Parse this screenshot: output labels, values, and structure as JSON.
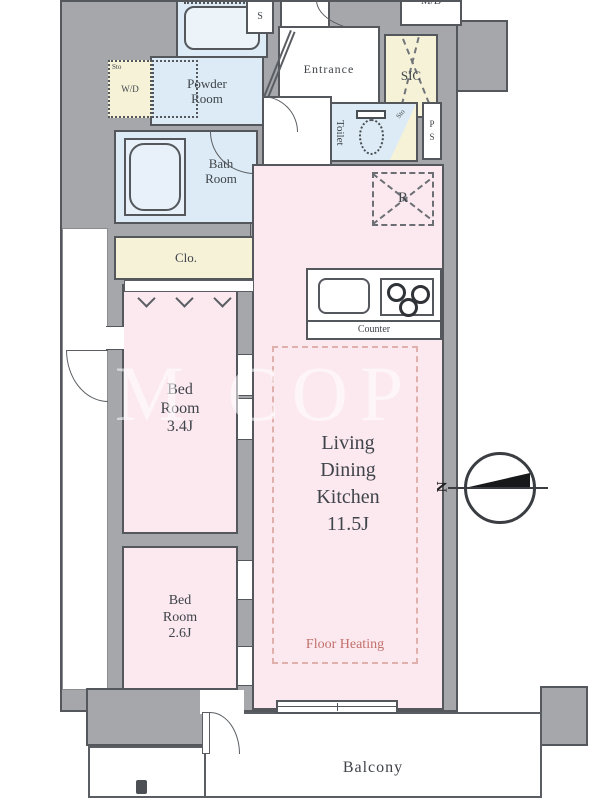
{
  "plan_type": "apartment-floor-plan",
  "watermark": {
    "text": "M COP"
  },
  "colors": {
    "wall": "#a5a7aa",
    "wet_area_blue": "#dcebf5",
    "storage_yellow": "#f6f2d8",
    "room_pink": "#fbe9ef",
    "heating_accent": "#c2706c"
  },
  "rooms": {
    "powder_room": {
      "name_lines": [
        "Powder",
        "Room"
      ]
    },
    "bath_room": {
      "name_lines": [
        "Bath",
        "Room"
      ]
    },
    "entrance": {
      "name": "Entrance"
    },
    "sic": {
      "name": "SIC"
    },
    "meter_box": {
      "name": "M/B"
    },
    "shaft_top": {
      "name": "S"
    },
    "pipe_space": {
      "letters": [
        "P",
        "S"
      ]
    },
    "toilet": {
      "name": "Toilet",
      "storage": "Sto"
    },
    "washer": {
      "storage": "Sto",
      "name": "W/D"
    },
    "closet": {
      "name": "Clo."
    },
    "bedroom_1": {
      "name_lines": [
        "Bed",
        "Room",
        "3.4J"
      ]
    },
    "bedroom_2": {
      "name_lines": [
        "Bed",
        "Room",
        "2.6J"
      ]
    },
    "ldk": {
      "name_lines": [
        "Living",
        "Dining",
        "Kitchen",
        "11.5J"
      ],
      "floor_heating": "Floor Heating"
    },
    "kitchen": {
      "counter": "Counter",
      "refrigerator": "R"
    },
    "balcony": {
      "name": "Balcony"
    }
  },
  "compass": {
    "north": "N"
  }
}
